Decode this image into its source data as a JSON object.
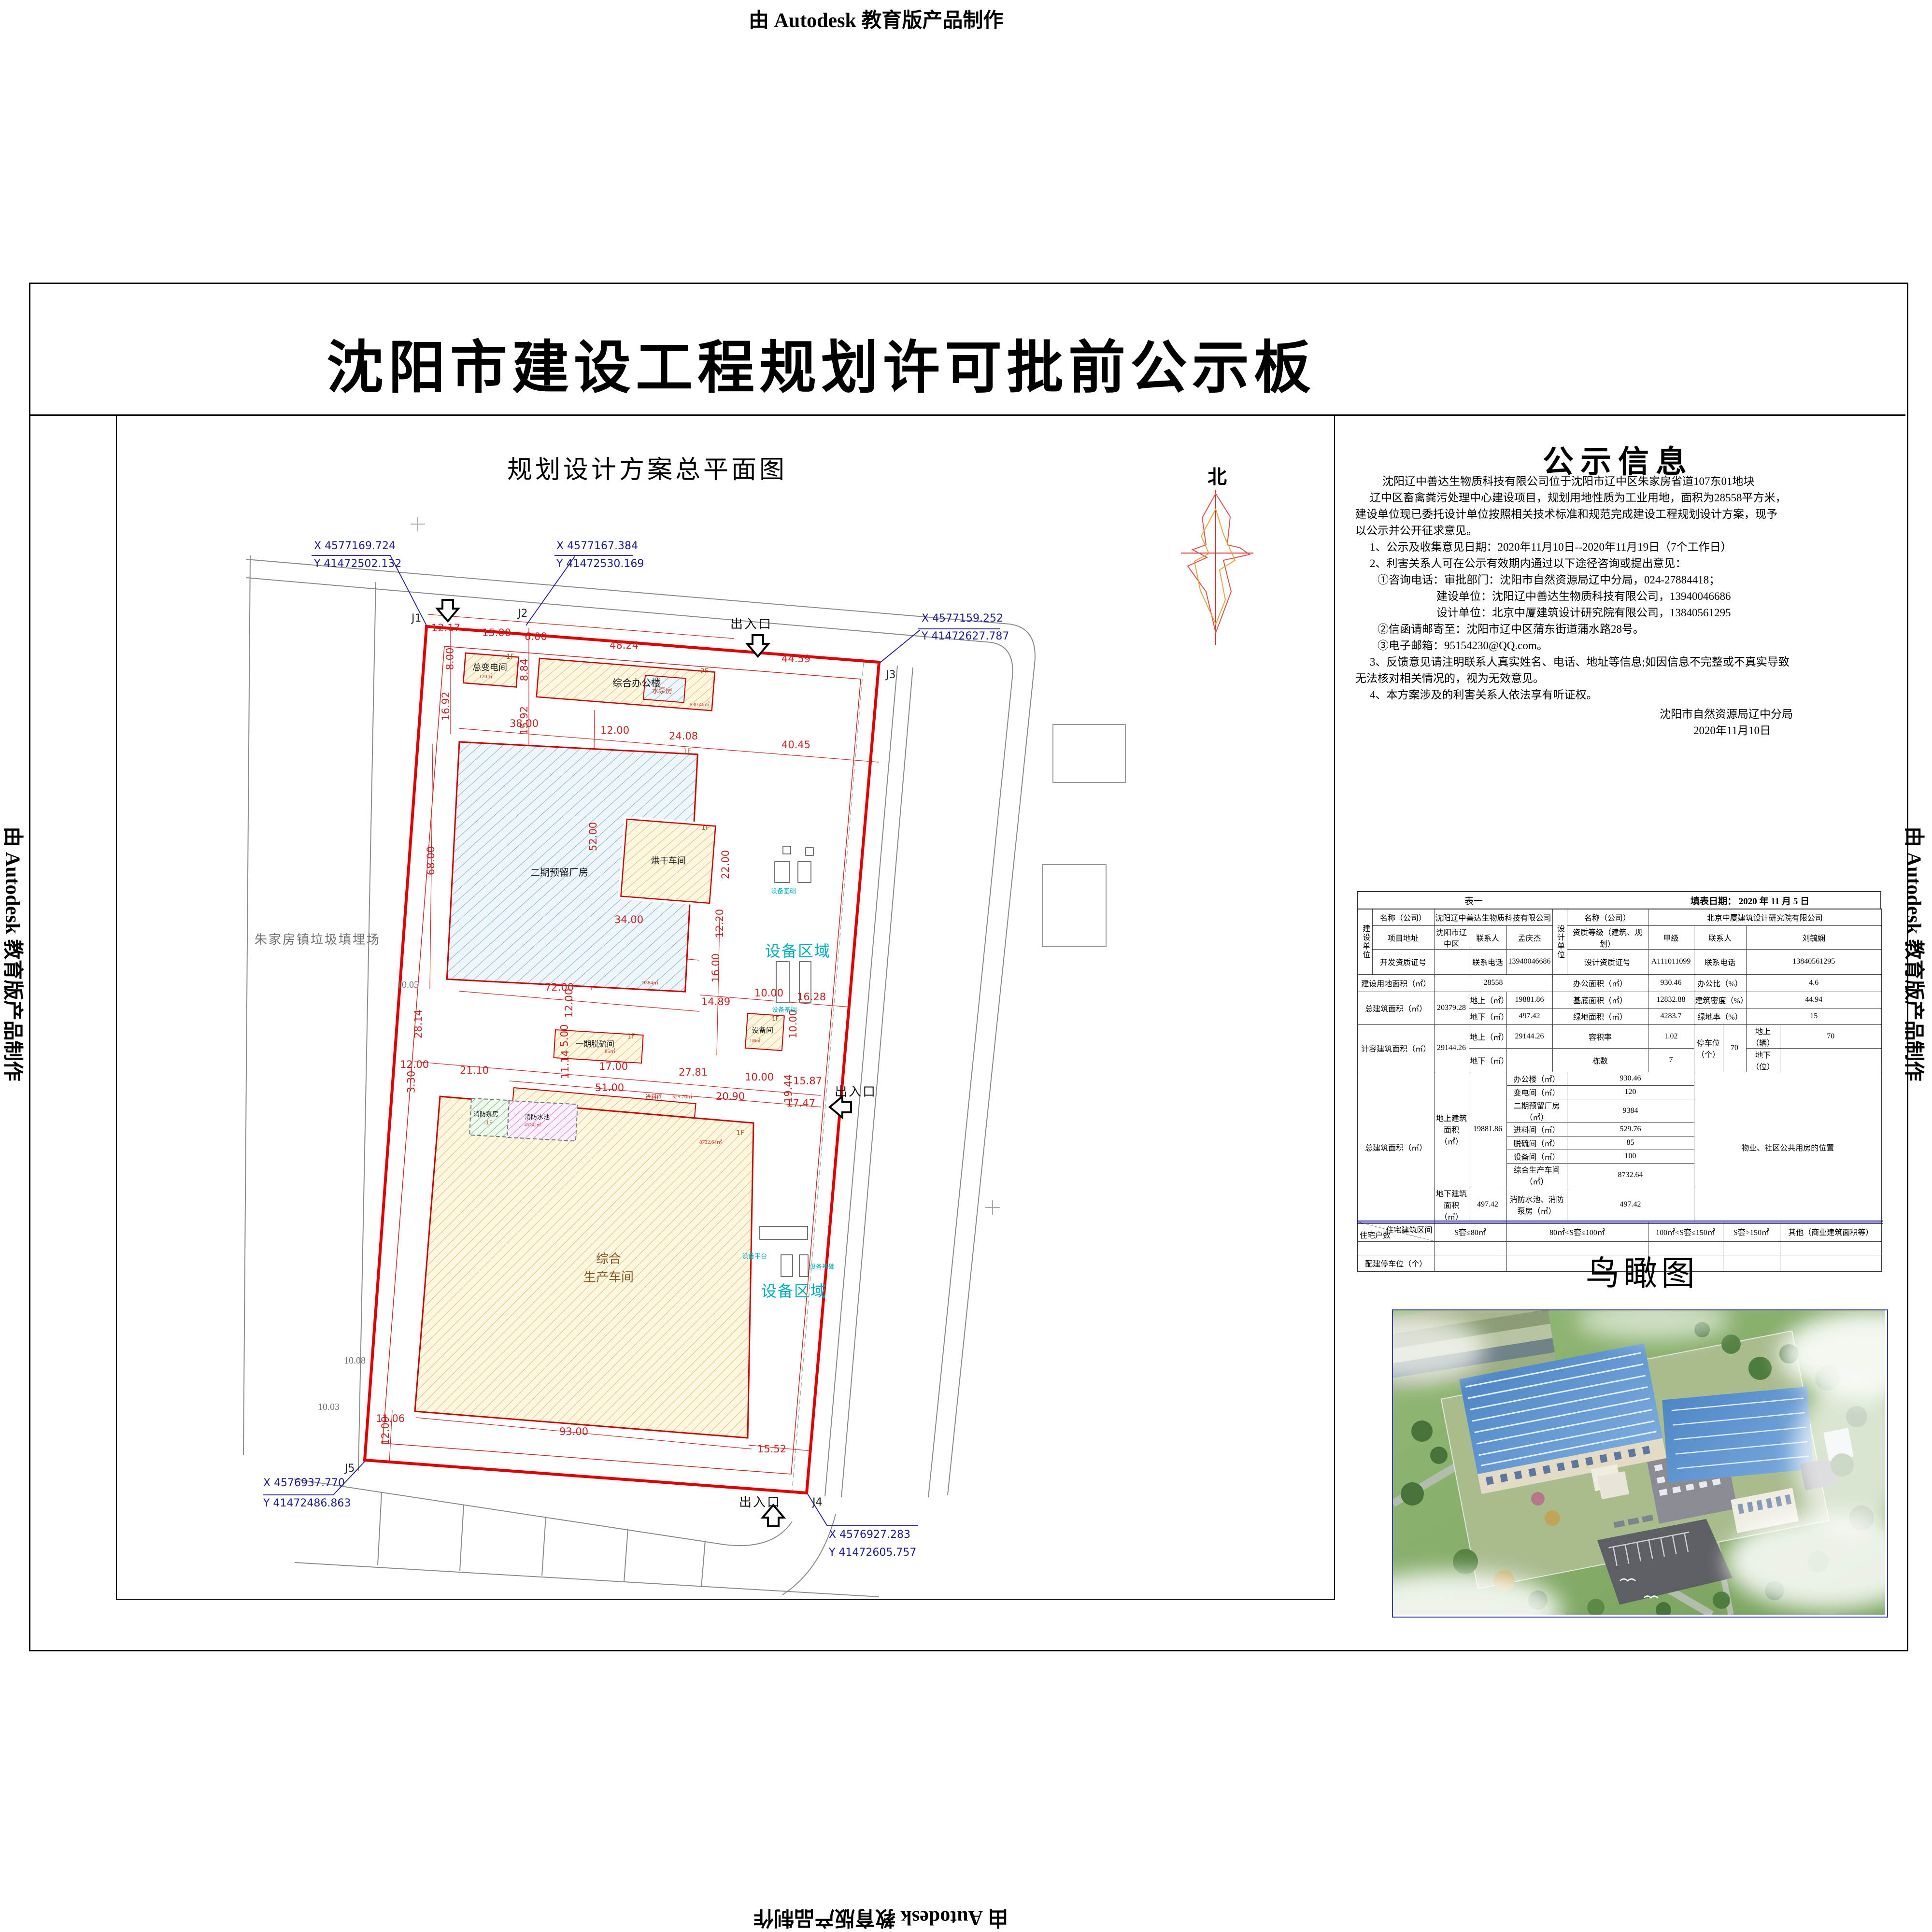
{
  "watermark": {
    "text": "由 Autodesk 教育版产品制作"
  },
  "title": "沈阳市建设工程规划许可批前公示板",
  "site_plan": {
    "title": "规划设计方案总平面图",
    "north_label": "北",
    "landfill_label": "朱家房镇垃圾填埋场",
    "entrance_top": "出入口",
    "entrance_right": "出入口",
    "entrance_bottom": "出入口",
    "corners": [
      "J1",
      "J2",
      "J3",
      "J4",
      "J5"
    ],
    "coordinates": [
      {
        "x": "X 4577169.724",
        "y": "Y 41472502.132"
      },
      {
        "x": "X 4577167.384",
        "y": "Y 41472530.169"
      },
      {
        "x": "X 4577159.252",
        "y": "Y 41472627.787"
      },
      {
        "x": "X 4576937.770",
        "y": "Y 41472486.863"
      },
      {
        "x": "X 4576927.283",
        "y": "Y 41472605.757"
      }
    ],
    "elevations": [
      "10.05",
      "10.08",
      "10.03"
    ],
    "dims": [
      "12.17",
      "15.00",
      "6.00",
      "48.24",
      "44.59",
      "8.00",
      "8.84",
      "16.92",
      "15.92",
      "38.00",
      "12.00",
      "24.08",
      "40.45",
      "68.00",
      "52.00",
      "34.00",
      "22.00",
      "12.20",
      "16.00",
      "72.00",
      "12.00",
      "28.14",
      "5.00",
      "17.00",
      "27.81",
      "10.00",
      "15.87",
      "12.00",
      "21.10",
      "3.30",
      "51.00",
      "11.14",
      "20.90",
      "19.44",
      "17.47",
      "14.89",
      "16.28",
      "10.00",
      "10.00",
      "93.00",
      "15.52",
      "11.06",
      "12.09"
    ],
    "buildings": {
      "b1": {
        "name": "总变电间",
        "floors": "1F",
        "area": "120㎡"
      },
      "b2": {
        "name": "综合办公楼",
        "floors": "2F",
        "area": "930.46㎡"
      },
      "b3": {
        "name": "水泵房"
      },
      "b4": {
        "name": "二期预留厂房",
        "floors": "1F",
        "area": "9384㎡"
      },
      "b5": {
        "name": "烘干车间",
        "floors": "1F"
      },
      "b6": {
        "name": "一期脱硫间",
        "floors": "1F",
        "area": "85㎡"
      },
      "b7": {
        "name": "设备间",
        "floors": "1F",
        "area": "100㎡"
      },
      "b8": {
        "name": "综合\n生产车间",
        "floors": "1F",
        "area": "8732.64㎡"
      },
      "b9": {
        "name": "消防泵房",
        "floors": "-1F"
      },
      "b10": {
        "name": "消防水池",
        "area": "497.42㎡"
      },
      "b11": {
        "name": "进料间",
        "area": "529.76㎡"
      }
    },
    "equipment": {
      "zone": "设备区域",
      "foundation": "设备基础",
      "platform": "设备平台"
    }
  },
  "notice": {
    "title": "公示信息",
    "lines": [
      "沈阳辽中善达生物质科技有限公司位于沈阳市辽中区朱家房省道107东01地块",
      "辽中区畜禽粪污处理中心建设项目，规划用地性质为工业用地，面积为28558平方米，",
      "建设单位现已委托设计单位按照相关技术标准和规范完成建设工程规划设计方案，现予",
      "以公示并公开征求意见。",
      "1、公示及收集意见日期：2020年11月10日--2020年11月19日（7个工作日）",
      "2、利害关系人可在公示有效期内通过以下途径咨询或提出意见：",
      "①咨询电话：审批部门：沈阳市自然资源局辽中分局，024-27884418；",
      "建设单位：沈阳辽中善达生物质科技有限公司，13940046686",
      "设计单位：北京中厦建筑设计研究院有限公司，13840561295",
      "②信函请邮寄至：沈阳市辽中区蒲东街道蒲水路28号。",
      "③电子邮箱：95154230@QQ.com。",
      "3、反馈意见请注明联系人真实姓名、电话、地址等信息;如因信息不完整或不真实导致",
      "无法核对相关情况的，视为无效意见。",
      "4、本方案涉及的利害关系人依法享有听证权。"
    ],
    "signature": [
      "沈阳市自然资源局辽中分局",
      "2020年11月10日"
    ]
  },
  "table": {
    "caption": "表一",
    "fill_date": "填表日期： 2020 年 11 月 5 日",
    "builder": {
      "group": "建设单位",
      "name_label": "名称（公司）",
      "name": "沈阳辽中善达生物质科技有限公司",
      "addr_label": "项目地址",
      "addr": "沈阳市辽中区",
      "contact_label": "联系人",
      "contact": "孟庆杰",
      "cert_label": "开发资质证号",
      "cert": "",
      "phone_label": "联系电话",
      "phone": "13940046686"
    },
    "designer": {
      "group": "设计单位",
      "name_label": "名称（公司）",
      "name": "北京中厦建筑设计研究院有限公司",
      "grade_label": "资质等级（建筑、规划）",
      "grade": "甲级",
      "contact_label": "联系人",
      "contact": "刘毓娴",
      "cert_label": "设计资质证号",
      "cert": "A111011099",
      "phone_label": "联系电话",
      "phone": "13840561295"
    },
    "m": {
      "land_label": "建设用地面积（㎡）",
      "land": "28558",
      "office_label": "办公面积（㎡）",
      "office": "930.46",
      "office_ratio_label": "办公比（%）",
      "office_ratio": "4.6",
      "total_label": "总建筑面积（㎡）",
      "total": "20379.28",
      "above_label": "地上（㎡）",
      "above": "19881.86",
      "footprint_label": "基底面积（㎡）",
      "footprint": "12832.88",
      "density_label": "建筑密度（%）",
      "density": "44.94",
      "below_label": "地下（㎡）",
      "below": "497.42",
      "green_label": "绿地面积（㎡）",
      "green": "4283.7",
      "green_rate_label": "绿地率（%）",
      "green_rate": "15",
      "capacity_label": "计容建筑面积（㎡）",
      "capacity": "29144.26",
      "cap_above": "29144.26",
      "far_label": "容积率",
      "far": "1.02",
      "parking_label": "停车位（个）",
      "parking": "70",
      "parking_above_label": "地上（辆）",
      "parking_above": "70",
      "blocks_label": "栋数",
      "blocks": "7",
      "parking_below_label": "地下（位）",
      "parking_below": "",
      "breakdown_total_label": "总建筑面积（㎡）",
      "above_area_label": "地上建筑面积（㎡）",
      "above_area": "19881.86",
      "below_area_label": "地下建筑面积（㎡）",
      "below_area": "497.42",
      "fire_label": "消防水池、消防泵房（㎡）",
      "fire": "497.42",
      "property_label": "物业、社区公共用房的位置",
      "housing_range_label": "住宅建筑区间",
      "housing_count_label": "住宅户数",
      "extra_parking_label": "配建停车位（个）"
    },
    "items": [
      [
        "办公楼（㎡）",
        "930.46"
      ],
      [
        "变电间（㎡）",
        "120"
      ],
      [
        "二期预留厂房（㎡）",
        "9384"
      ],
      [
        "进料间（㎡）",
        "529.76"
      ],
      [
        "脱硫间（㎡）",
        "85"
      ],
      [
        "设备间（㎡）",
        "100"
      ],
      [
        "综合生产车间（㎡）",
        "8732.64"
      ]
    ],
    "ranges": [
      "S套≤80㎡",
      "80㎡<S套≤100㎡",
      "100㎡<S套≤150㎡",
      "S套>150㎡",
      "其他（商业建筑面积等）"
    ]
  },
  "aerial": {
    "title": "鸟瞰图"
  }
}
